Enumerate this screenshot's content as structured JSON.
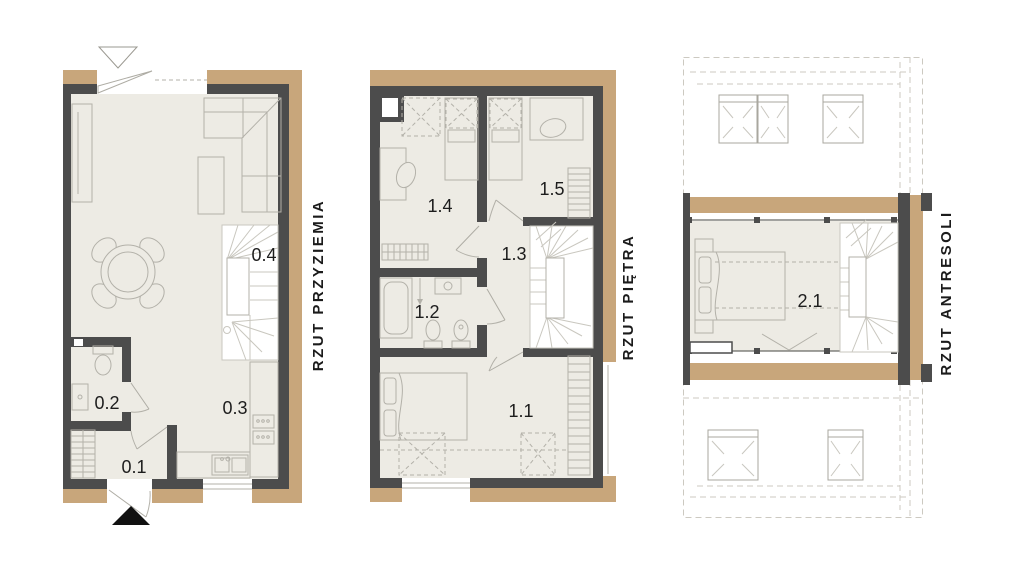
{
  "document": {
    "type": "architectural-floor-plans",
    "plan_count": 3
  },
  "colors": {
    "wall": "#4c4c4c",
    "insulation": "#c8a67b",
    "floor": "#edebe4",
    "furniture_outline": "#b3b1a9",
    "roof_dashed": "#ccc9c1",
    "text": "#1d1d1d",
    "entrance_marker": "#111111",
    "background": "#ffffff"
  },
  "icons": {
    "main_entrance": "filled-triangle-up",
    "secondary_entrance": "outline-triangle-down"
  },
  "plans": [
    {
      "key": "ground",
      "title": "RZUT PRZYZIEMIA",
      "rooms": [
        {
          "label": "0.1"
        },
        {
          "label": "0.2"
        },
        {
          "label": "0.3"
        },
        {
          "label": "0.4"
        }
      ]
    },
    {
      "key": "first-floor",
      "title": "RZUT PIĘTRA",
      "rooms": [
        {
          "label": "1.1"
        },
        {
          "label": "1.2"
        },
        {
          "label": "1.3"
        },
        {
          "label": "1.4"
        },
        {
          "label": "1.5"
        }
      ]
    },
    {
      "key": "mezzanine",
      "title": "RZUT ANTRESOLI",
      "rooms": [
        {
          "label": "2.1"
        }
      ]
    }
  ]
}
